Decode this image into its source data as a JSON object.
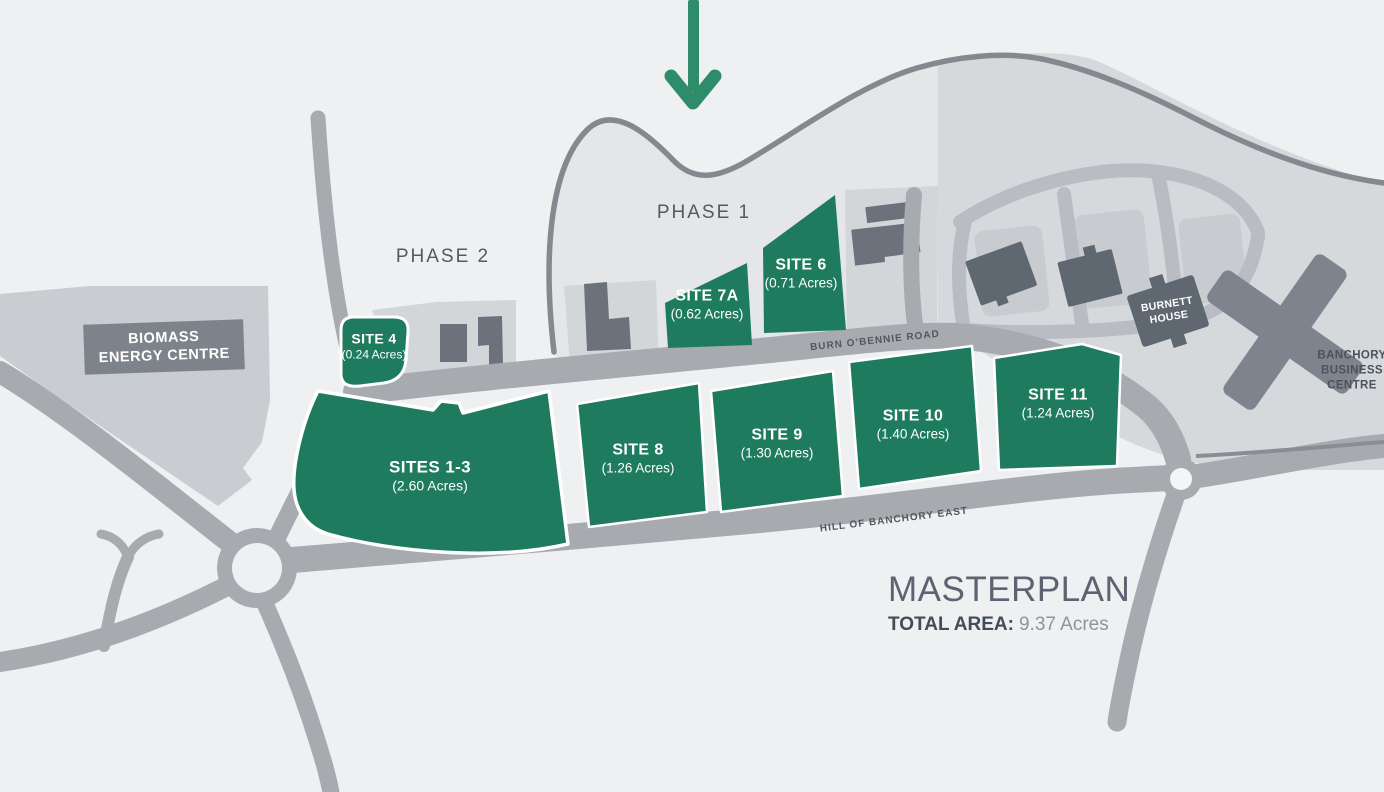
{
  "title": "Hill of Banchory masterplan map",
  "colors": {
    "site_green": "#1e7b5e",
    "arrow_green": "#2e8c6b",
    "road_grey": "#a7abb0",
    "building_grey": "#5f6771",
    "background": "#eef0f1"
  },
  "phases": {
    "phase1": "PHASE 1",
    "phase2": "PHASE 2"
  },
  "sites": [
    {
      "name": "SITES 1-3",
      "area": "(2.60 Acres)"
    },
    {
      "name": "SITE 4",
      "area": "(0.24 Acres)"
    },
    {
      "name": "SITE 6",
      "area": "(0.71 Acres)"
    },
    {
      "name": "SITE 7A",
      "area": "(0.62 Acres)"
    },
    {
      "name": "SITE 8",
      "area": "(1.26 Acres)"
    },
    {
      "name": "SITE 9",
      "area": "(1.30 Acres)"
    },
    {
      "name": "SITE 10",
      "area": "(1.40 Acres)"
    },
    {
      "name": "SITE 11",
      "area": "(1.24 Acres)"
    }
  ],
  "roads": {
    "burn": "BURN O’BENNIE ROAD",
    "hill": "HILL OF BANCHORY EAST"
  },
  "landmarks": {
    "biomass": {
      "line1": "BIOMASS",
      "line2": "ENERGY CENTRE"
    },
    "burnett": {
      "line1": "BURNETT",
      "line2": "HOUSE"
    },
    "banchory": {
      "line1": "BANCHORY",
      "line2": "BUSINESS",
      "line3": "CENTRE"
    }
  },
  "legend": {
    "title": "MASTERPLAN",
    "total_area_label": "TOTAL AREA:",
    "total_area_value": "9.37 Acres"
  }
}
